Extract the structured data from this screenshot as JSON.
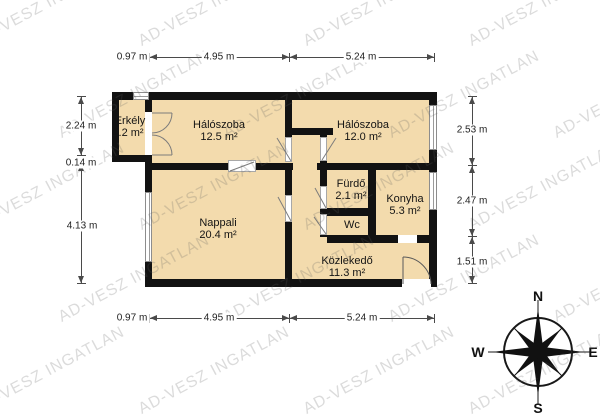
{
  "watermark": {
    "text": "AD-VESZ INGATLAN"
  },
  "rooms": {
    "erkely": {
      "name": "Erkély",
      "area": "2.2 m²"
    },
    "bedroom1": {
      "name": "Hálószoba",
      "area": "12.5 m²"
    },
    "bedroom2": {
      "name": "Hálószoba",
      "area": "12.0 m²"
    },
    "nappali": {
      "name": "Nappali",
      "area": "20.4 m²"
    },
    "furdo": {
      "name": "Fürdő",
      "area": "2.1 m²"
    },
    "wc": {
      "name": "Wc"
    },
    "konyha": {
      "name": "Konyha",
      "area": "5.3 m²"
    },
    "kozlekedo": {
      "name": "Közlekedő",
      "area": "11.3 m²"
    }
  },
  "dimensions": {
    "top": [
      "0.97 m",
      "4.95 m",
      "5.24 m"
    ],
    "bottom": [
      "0.97 m",
      "4.95 m",
      "5.24 m"
    ],
    "left": [
      "2.24 m",
      "0.14 m",
      "4.13 m"
    ],
    "right": [
      "2.53 m",
      "2.47 m",
      "1.51 m"
    ]
  },
  "compass": {
    "north": "N",
    "south": "S",
    "east": "E",
    "west": "W"
  },
  "colors": {
    "floor_fill": "#f3dbad",
    "wall": "#121212",
    "watermark": "#b9b9b9",
    "dimension": "#4a4a4a"
  }
}
